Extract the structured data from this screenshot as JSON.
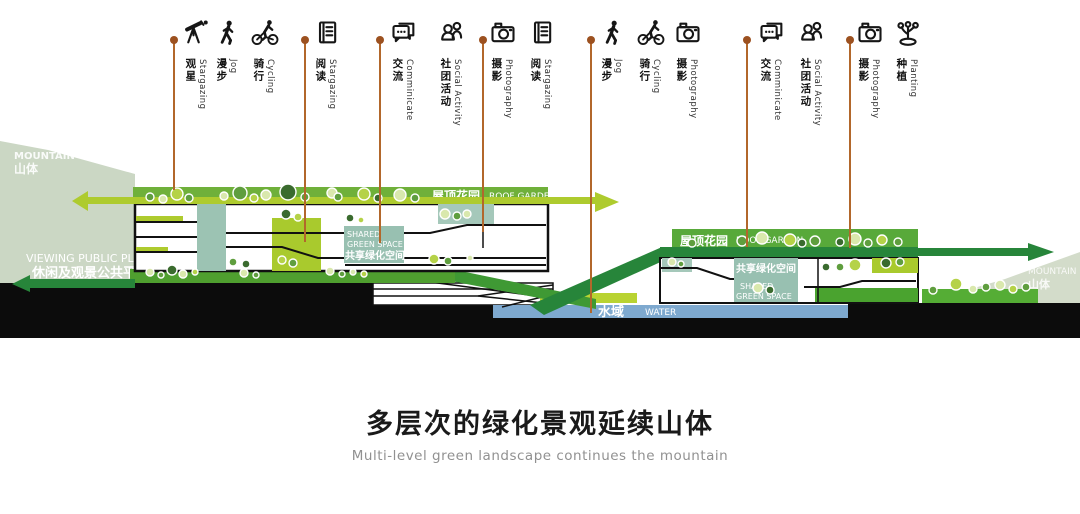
{
  "activities": {
    "items": [
      {
        "cn": "观星",
        "en": "Stargazing",
        "icon": "telescope-icon"
      },
      {
        "cn": "漫步",
        "en": "Jog",
        "icon": "walking-person-icon"
      },
      {
        "cn": "骑行",
        "en": "Cycling",
        "icon": "cyclist-icon"
      },
      {
        "cn": "阅读",
        "en": "Stargazing",
        "icon": "book-icon"
      },
      {
        "cn": "交流",
        "en": "Comminicate",
        "icon": "chat-bubbles-icon"
      },
      {
        "cn": "社团活动",
        "en": "Social Activity",
        "icon": "people-icon"
      },
      {
        "cn": "摄影",
        "en": "Photography",
        "icon": "camera-icon"
      },
      {
        "cn": "阅读",
        "en": "Stargazing",
        "icon": "book-icon"
      },
      {
        "cn": "漫步",
        "en": "Jog",
        "icon": "walking-person-icon"
      },
      {
        "cn": "骑行",
        "en": "Cycling",
        "icon": "cyclist-icon"
      },
      {
        "cn": "摄影",
        "en": "Photography",
        "icon": "camera-icon"
      },
      {
        "cn": "交流",
        "en": "Comminicate",
        "icon": "chat-bubbles-icon"
      },
      {
        "cn": "社团活动",
        "en": "Social Activity",
        "icon": "people-icon"
      },
      {
        "cn": "摄影",
        "en": "Photography",
        "icon": "camera-icon"
      },
      {
        "cn": "种植",
        "en": "Planting",
        "icon": "sprout-icon"
      }
    ]
  },
  "labels": {
    "roof_garden_left": {
      "cn": "屋顶花园",
      "en": "ROOF GARDEN"
    },
    "roof_garden_right": {
      "cn": "屋顶花园",
      "en": "ROOF GARDEN"
    },
    "shared_space_left": {
      "line1": "SHARED",
      "line2": "GREEN SPACE",
      "line3": "共享绿化空间"
    },
    "shared_space_right": {
      "line1": "共享绿化空间",
      "line2": "SHARED",
      "line3": "GREEN SPACE"
    },
    "water": {
      "cn": "水域",
      "en": "WATER"
    },
    "mountain_left": {
      "en": "MOUNTAIN",
      "cn": "山体"
    },
    "mountain_right": {
      "en": "MOUNTAIN",
      "cn": "山体"
    },
    "platform": {
      "en": "VIEWING PUBLIC PLATFORM",
      "cn": "休闲及观景公共平台"
    }
  },
  "title": {
    "cn": "多层次的绿化景观延续山体",
    "en": "Multi-level green landscape continues the mountain"
  },
  "colors": {
    "roof_green": "#6fb03a",
    "lime_accent": "#aecb2e",
    "dark_green_path": "#27853a",
    "platform_green": "#4f9f2f",
    "teal_space": "#9cc3b3",
    "water_blue": "#7ea9cf",
    "mountain_sage": "#cbd7c4",
    "ground_black": "#0c0c0c",
    "leader_orange": "#b2672b"
  }
}
